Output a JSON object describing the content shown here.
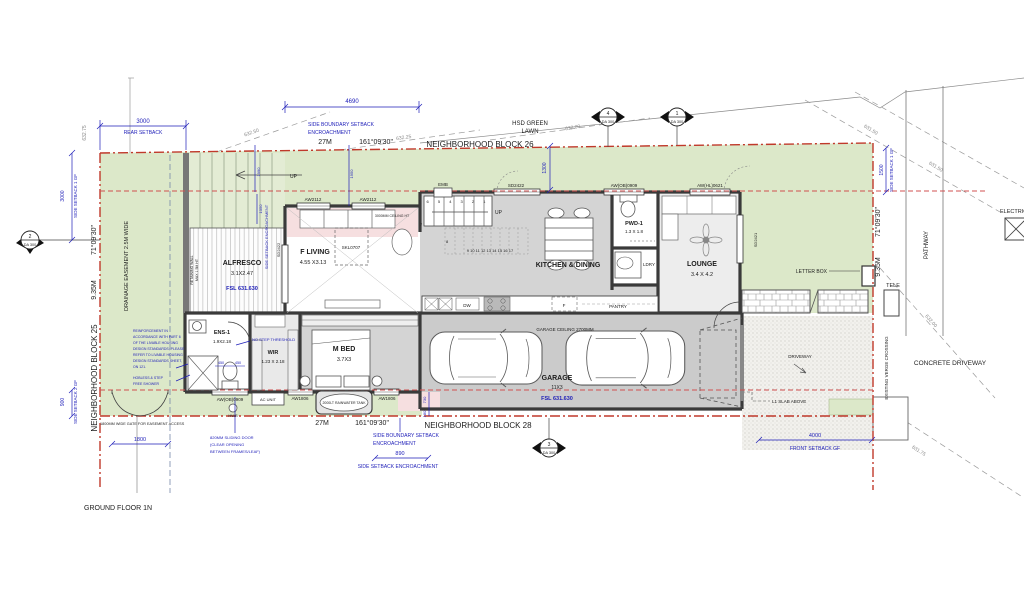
{
  "sheet": {
    "title": "GROUND FLOOR 1N"
  },
  "blocks": {
    "north": "NEIGHBORHOOD BLOCK 26",
    "south": "NEIGHBORHOOD BLOCK 28",
    "west": "NEIGHBORHOOD BLOCK 25"
  },
  "boundaries": {
    "north_length": "27M",
    "north_bearing": "161°09'30\"",
    "south_length": "27M",
    "south_bearing": "161°09'30\"",
    "west_length": "9.35M",
    "west_bearing": "71°09'30\"",
    "east_length": "9.35M",
    "east_bearing": "71°09'30\""
  },
  "setbacks": {
    "rear_dim": "3000",
    "rear_label": "REAR SETBACK",
    "side1_left_dim": "3000",
    "side1_left_label": "SIDE SETBACK 1 GF",
    "side1_right_dim": "1500",
    "side1_right_label": "SIDE SETBACK 1 GF",
    "side2_dim": "900",
    "side2_label": "SIDE SETBACK 2 GF",
    "front_dim": "4000",
    "front_label": "FRONT SETBACK GF",
    "encroach_top_line1": "SIDE BOUNDARY SETBACK",
    "encroach_top_line2": "ENCROACHMENT",
    "encroach_bottom_line1": "SIDE BOUNDARY SETBACK",
    "encroach_bottom_line2": "ENCROACHMENT",
    "encroach_side_dim": "890",
    "encroach_side_label": "SIDE SETBACK ENCROACHMENT",
    "encroach_vertical": "SIDE SETBACK ENCROACHMENT",
    "dim_4690": "4690",
    "dim_1300": "1300",
    "dim_1050": "1050",
    "dim_1990": "1990",
    "dim_1950": "1950",
    "dim_730": "730",
    "dim_180": "180"
  },
  "site_labels": {
    "lawn_line1": "HSD GREEN",
    "lawn_line2": "LAWN",
    "drainage": "DRAINAGE EASEMENT 2.5M WIDE",
    "retaining_line1": "RETAINING WALL",
    "retaining_line2": "MAX 1.5M HT",
    "gate_note": "1800MM WIDE GATE FOR EASEMENT ACCESS",
    "gate_dim": "1800",
    "driveway": "DRIVEWAY",
    "concrete_driveway": "CONCRETE DRIVEWAY",
    "pathway": "PATHWAY",
    "verge": "EXISTING VERGE CROSSING",
    "tele": "TELE",
    "electrical": "ELECTRICAL",
    "letter_box": "LETTER BOX",
    "l1_slab": "L1 SLAB ABOVE",
    "emb": "EMB"
  },
  "contours": {
    "c1": "632.75",
    "c2": "632.50",
    "c3": "632.25",
    "c4": "632.00",
    "c5": "631.50",
    "c6": "631.50",
    "c7": "632.00",
    "c8": "631.75"
  },
  "markers": {
    "da": "DA 300",
    "m1": "1",
    "m2": "2",
    "m3": "3",
    "m4": "4"
  },
  "rooms": {
    "alfresco": {
      "name": "ALFRESCO",
      "dims": "3.1X2.47",
      "fsl": "FSL 631.630"
    },
    "f_living": {
      "name": "F LIVING",
      "dims": "4.55 X3.13",
      "ceiling": "3000MM CEILING HT",
      "skylight": "SKL0707"
    },
    "kitchen": {
      "name": "KITCHEN & DINING",
      "dw": "DW",
      "fridge": "F",
      "pantry": "PANTRY"
    },
    "lounge": {
      "name": "LOUNGE",
      "dims": "3.4 X 4.2"
    },
    "pwd": {
      "name": "PWD-1",
      "dims": "1.3 X 1.8"
    },
    "ldry": {
      "name": "LDRY"
    },
    "ens": {
      "name": "ENS-1",
      "dims": "1.9X2.18"
    },
    "wir": {
      "name": "WIR",
      "dims": "1.23 X 2.18"
    },
    "mbed": {
      "name": "M BED",
      "dims": "3.7X3"
    },
    "garage": {
      "name": "GARAGE",
      "dims": "11X3",
      "fsl": "FSL 631.630",
      "ceiling": "GARAGE CEILING 2700MM"
    }
  },
  "stairs": {
    "up_internal": "UP",
    "up_external": "UP",
    "run_lower": "6 5 4 3 2 1",
    "run_upper": "9 10 11 12 13 14 15 16 17",
    "step7": "7",
    "step8": "8"
  },
  "openings": {
    "aw2112": "AW2112",
    "sd2422": "SD2422",
    "sd2421": "SD2421",
    "aw_ob_0909": "AW(OB)0909",
    "aw_hl_0621": "AW(HL)0621",
    "aw1806": "AW1806",
    "ac_unit": "AC UNIT",
    "hws": "HWS",
    "tank": "2000LT RAINWATER TANK"
  },
  "notes": {
    "reinforcement": [
      "REINFORCEMENT IN",
      "ACCORDANCE WITH PART 6",
      "OF THE LIVABLE HOUSING",
      "DESIGN STANDARDS; PLEASE",
      "REFER TO LIVABLE HOUSING",
      "DESIGN STANDARDS SHEET,",
      "ON 121."
    ],
    "shower": [
      "HOBLESS & STEP",
      "FREE SHOWER"
    ],
    "sliding": [
      "820MM SLIDING DOOR",
      "(CLEAR OPENING",
      "BETWEEN FRAMES/LEAF)"
    ],
    "no_step": "NO STEP THRESHOLD",
    "d450a": "450",
    "d450b": "450"
  },
  "colors": {
    "annotation_blue": "#1d1db8",
    "boundary_red": "#c0392b",
    "lawn_green": "#dce8c9",
    "wall_gray": "#3a3a3a",
    "raked_pink": "#f6dfe0"
  }
}
